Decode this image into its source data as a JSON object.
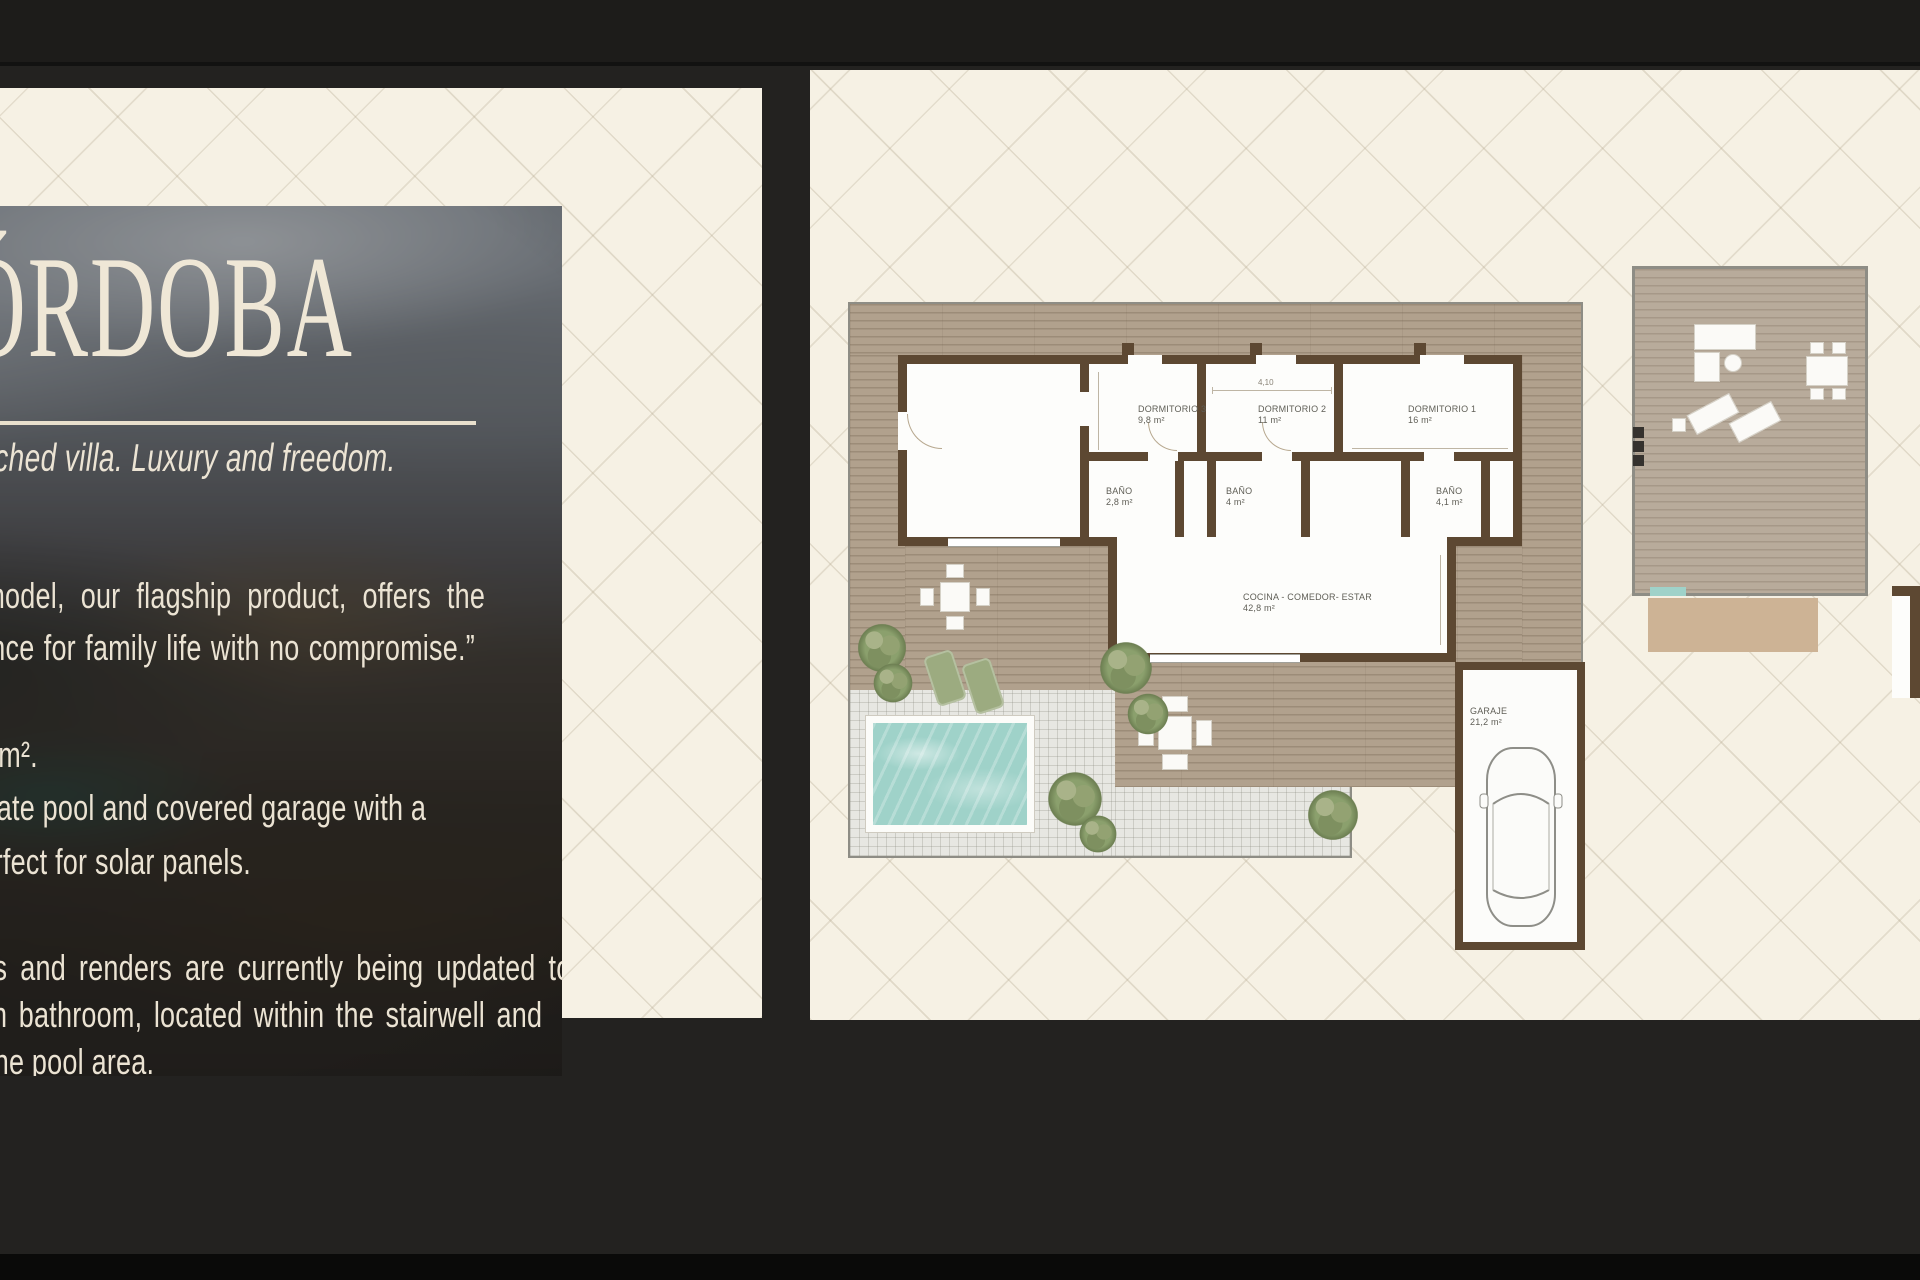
{
  "left_panel": {
    "title": "CÓRDOBA",
    "subtitle": "Large detached villa. Luxury and freedom.",
    "quote_lines": [
      "e Córdoba model, our flagship product, offers the",
      "mate experience for family life with no compromise.”"
    ],
    "details_lines": [
      "arium of 99,5 m².",
      "eatures a private pool and covered garage with a",
      ",8 m² roof, perfect for solar panels."
    ],
    "note_lines": [
      "e: Floor plans and renders are currently being updated to",
      "ude the fourth bathroom, located within the stairwell and",
      "essible from the pool area."
    ]
  },
  "floor_plan": {
    "rooms": [
      {
        "name": "DORMITORIO 3",
        "area": "9,8 m²"
      },
      {
        "name": "DORMITORIO 2",
        "area": "11 m²"
      },
      {
        "name": "DORMITORIO 1",
        "area": "16 m²"
      },
      {
        "name": "BAÑO",
        "area": "2,8 m²"
      },
      {
        "name": "BAÑO",
        "area": "4 m²"
      },
      {
        "name": "BAÑO",
        "area": "4,1 m²"
      },
      {
        "name": "COCINA - COMEDOR- ESTAR",
        "area": "42,8 m²"
      },
      {
        "name": "GARAJE",
        "area": "21,2 m²"
      }
    ],
    "dimensions": {
      "bedroom2_width": "4,10"
    },
    "colors": {
      "deck_wood": "#b1a18d",
      "walls": "#5d4832",
      "pool": "#9fd2c9",
      "patio": "#e7e7e2",
      "plants": "#8ba06d",
      "card_cream": "#f6f1e4",
      "page_dark": "#232220"
    }
  }
}
